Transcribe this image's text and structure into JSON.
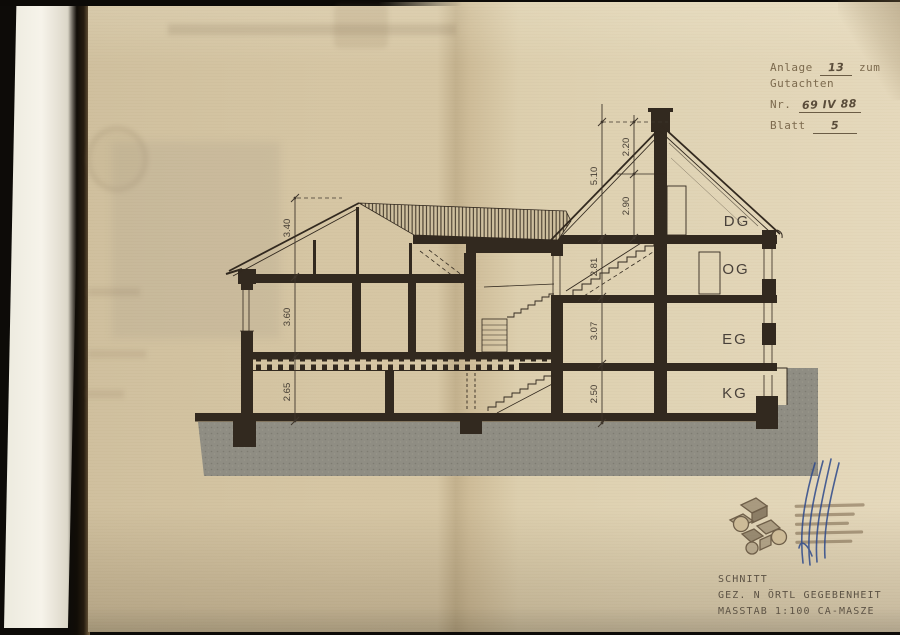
{
  "colors": {
    "paper_left": "#d5c5a3",
    "paper_right": "#e5d8bb",
    "ink": "#32291f",
    "ground_gray": "#8f8d83",
    "signature_blue": "#2e4a8c",
    "stamp_brown": "#6f5f49"
  },
  "annotation_block": {
    "anlage_label": "Anlage",
    "anlage_value": "13",
    "zum_label": "zum",
    "gutachten_label": "Gutachten",
    "nr_label": "Nr.",
    "nr_value": "69 IV 88",
    "blatt_label": "Blatt",
    "blatt_value": "5"
  },
  "title_block": {
    "line1": "SCHNITT",
    "line2": "GEZ. N ÖRTL GEGEBENHEIT",
    "line3": "MASSTAB 1:100 CA-MASZE"
  },
  "drawing": {
    "floor_labels": [
      "DG",
      "OG",
      "EG",
      "KG"
    ],
    "dims_left": [
      "3.40",
      "3.60",
      "2.65"
    ],
    "dims_right_inner": [
      "5.10",
      "2.81",
      "3.07",
      "2.50"
    ],
    "dims_right_outer": [
      "2.20",
      "2.90"
    ]
  }
}
